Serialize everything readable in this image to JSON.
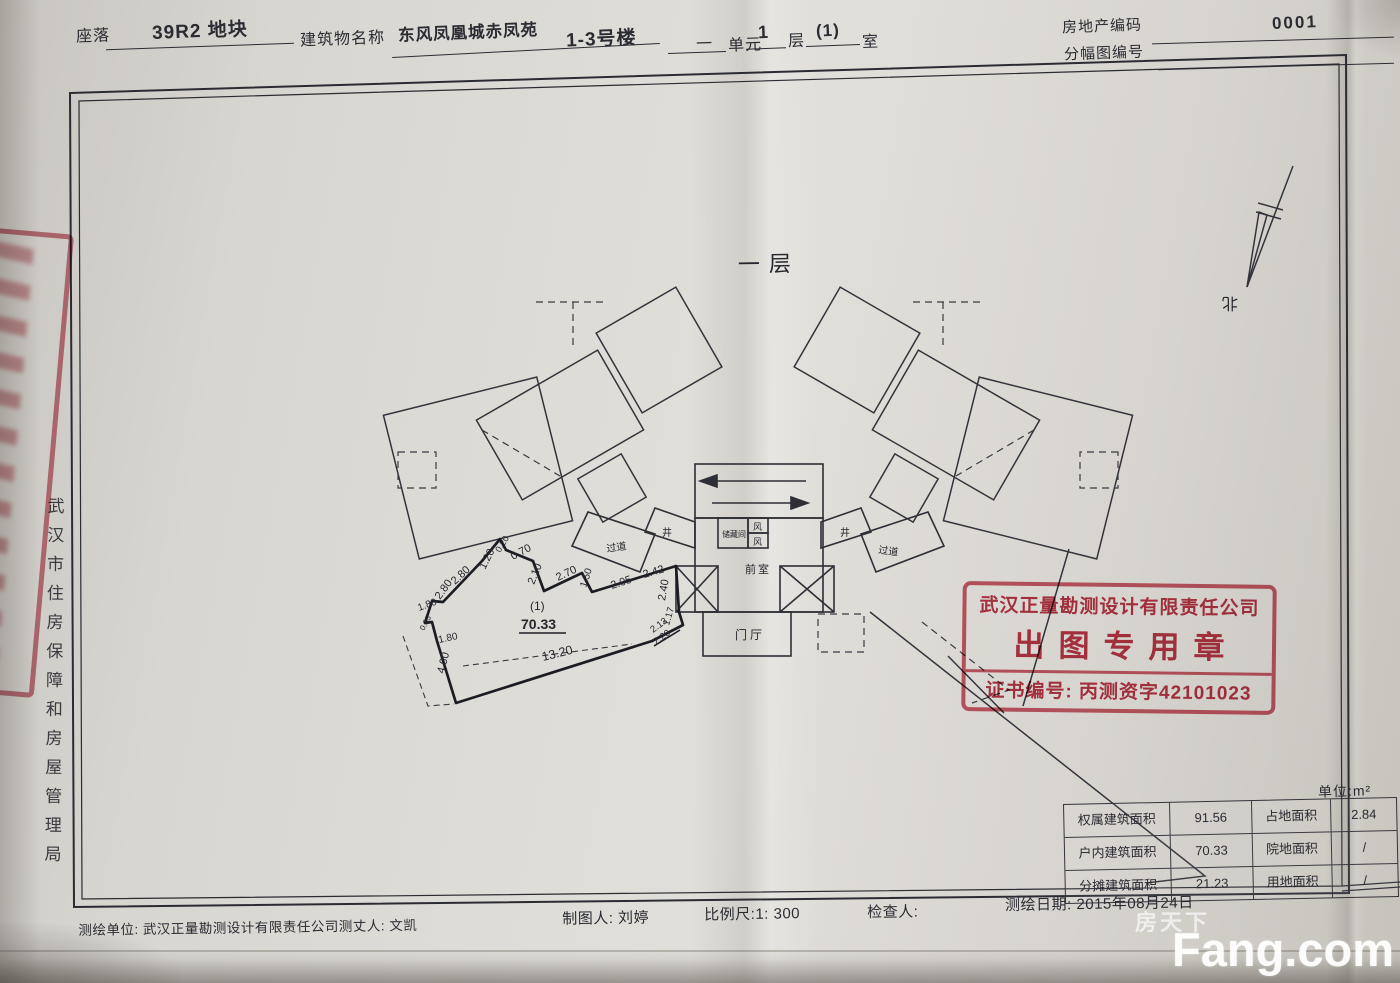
{
  "header": {
    "site_label": "座落",
    "site_value": "39R2 地块",
    "building_label": "建筑物名称",
    "building_value": "东风凤凰城赤凤苑",
    "building_no": "1-3号楼",
    "unit_prefix": "一",
    "unit_label": "单元",
    "unit_value": "1",
    "floor_label": "层",
    "room_value": "(1)",
    "room_label": "室",
    "estate_code_label": "房地产编码",
    "estate_code_value": "0001",
    "sheet_no_label": "分幅图编号"
  },
  "left_margin": {
    "authority": "武汉市住房保障和房屋管理局"
  },
  "plan": {
    "floor_title": "一层",
    "north_label": "北",
    "rooms": {
      "passage_left": "过道",
      "passage_right": "过道",
      "shaft_left": "井",
      "shaft_right": "井",
      "storage": "储藏间",
      "wind1": "风",
      "wind2": "风",
      "front_room": "前室",
      "entrance_hall": "门厅"
    },
    "unit_no": "(1)",
    "unit_area": "70.33",
    "dims": {
      "t1": "2.80",
      "t2": "1.20",
      "t3": "0.20",
      "t4": "0.70",
      "t5": "2.10",
      "t6": "2.70",
      "t7": "1.50",
      "t8": "2.05",
      "t9": "2.42",
      "r1": "2.40",
      "r2": "1.17",
      "r3": "2.13",
      "r4": "2.20",
      "l1": "2.80",
      "l2": "1.80",
      "l3": "0.33",
      "l4": "1.80",
      "l5": "4.00",
      "b1": "13.20"
    }
  },
  "stamp_main": {
    "line1": "武汉正量勘测设计有限责任公司",
    "line2": "出图专用章",
    "line3": "证书编号: 丙测资字42101023"
  },
  "area_table": {
    "unit_note": "单位:m²",
    "rows": [
      {
        "k1": "权属建筑面积",
        "v1": "91.56",
        "k2": "占地面积",
        "v2": "2.84"
      },
      {
        "k1": "户内建筑面积",
        "v1": "70.33",
        "k2": "院地面积",
        "v2": "/"
      },
      {
        "k1": "分摊建筑面积",
        "v1": "21.23",
        "k2": "用地面积",
        "v2": "/"
      }
    ]
  },
  "footer": {
    "surveyor_line": "测绘单位: 武汉正量勘测设计有限责任公司测丈人: 文凯",
    "drafter": "制图人: 刘婷",
    "scale": "比例尺:1:  300",
    "checker": "检查人:",
    "survey_date": "测绘日期: 2015年08月24日"
  },
  "watermark": {
    "brand": "Fang.com",
    "cn": "房天下"
  }
}
